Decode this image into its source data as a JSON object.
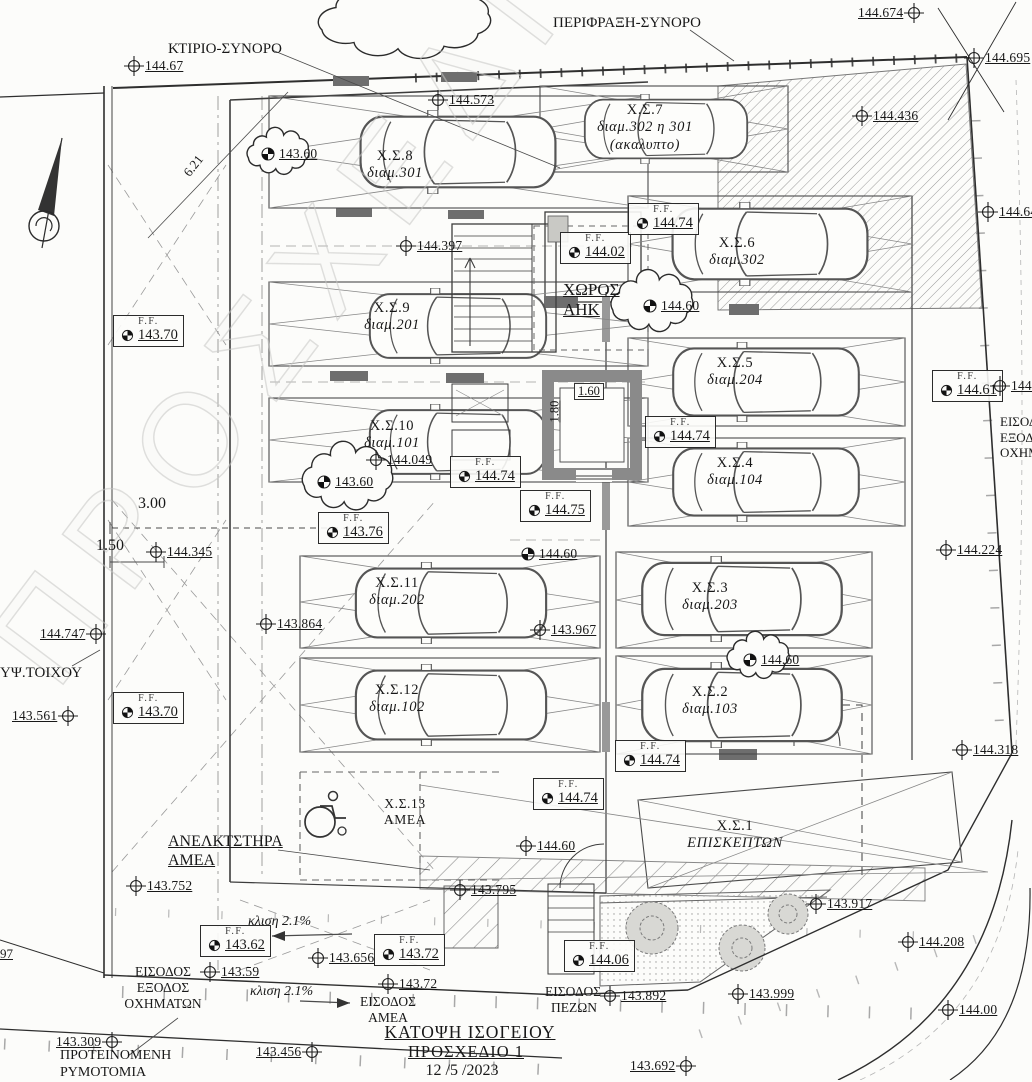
{
  "drawing": {
    "title_line1": "ΚΑΤΟΨΗ ΙΣΟΓΕΙΟΥ",
    "title_line2": "ΠΡΟΣΧΕΔΙΟ 1",
    "date": "12 /5 /2023",
    "watermark": "ΠΡΟΣΧΕΔΙΟ"
  },
  "boundary": {
    "building_label": "ΚΤΙΡΙΟ-ΣΥΝΟΡΟ",
    "fence_label": "ΠΕΡΙΦΡΑΞΗ-ΣΥΝΟΡΟ",
    "wall_height_label": "ΥΨ.ΤΟΙΧΟΥ",
    "proposed_line1": "ΠΡΟΤΕΙΝΟΜΕΝΗ",
    "proposed_line2": "ΡΥΜΟΤΟΜΙΑ"
  },
  "rooms": {
    "ahk_line1": "ΧΩΡΟΣ",
    "ahk_line2": "ΑΗΚ",
    "lift_line1": "ΑΝΕΛΚΤΣΤΗΡΑ",
    "lift_line2": "ΑΜΕΑ"
  },
  "entrances": {
    "vehicles_line1": "ΕΙΣΟΔΟΣ",
    "vehicles_line2": "ΕΞΟΔΟΣ",
    "vehicles_line3": "ΟΧΗΜΑΤΩΝ",
    "amea_line1": "ΕΙΣΟΔΟΣ",
    "amea_line2": "ΑΜΕΑ",
    "pedestrian_line1": "ΕΙΣΟΔΟΣ",
    "pedestrian_line2": "ΠΕΖΩΝ",
    "slope1": "κλιση 2.1%",
    "slope2": "κλιση 2.1%",
    "right": [
      "ΕΙΣΟΔ",
      "ΕΞΟΔ",
      "ΟΧΗΜ"
    ]
  },
  "parking": [
    {
      "name": "Χ.Σ.1",
      "sub": "ΕΠΙΣΚΕΠΤΩΝ"
    },
    {
      "name": "Χ.Σ.2",
      "sub": "διαμ.103"
    },
    {
      "name": "Χ.Σ.3",
      "sub": "διαμ.203"
    },
    {
      "name": "Χ.Σ.4",
      "sub": "διαμ.104"
    },
    {
      "name": "Χ.Σ.5",
      "sub": "διαμ.204"
    },
    {
      "name": "Χ.Σ.6",
      "sub": "διαμ.302"
    },
    {
      "name": "Χ.Σ.7",
      "sub": "διαμ.302  η  301",
      "sub2": "(ακαλυπτο)"
    },
    {
      "name": "Χ.Σ.8",
      "sub": "διαμ.301"
    },
    {
      "name": "Χ.Σ.9",
      "sub": "διαμ.201"
    },
    {
      "name": "Χ.Σ.10",
      "sub": "διαμ.101"
    },
    {
      "name": "Χ.Σ.11",
      "sub": "διαμ.202"
    },
    {
      "name": "Χ.Σ.12",
      "sub": "διαμ.102"
    },
    {
      "name": "Χ.Σ.13",
      "sub": "ΑΜΕΑ"
    }
  ],
  "ff_label": "F.F.",
  "ff": [
    {
      "v": "143.70"
    },
    {
      "v": "144.02"
    },
    {
      "v": "144.74"
    },
    {
      "v": "144.74"
    },
    {
      "v": "144.75"
    },
    {
      "v": "144.74"
    },
    {
      "v": "143.76"
    },
    {
      "v": "143.70"
    },
    {
      "v": "144.74"
    },
    {
      "v": "144.74"
    },
    {
      "v": "144.61"
    },
    {
      "v": "143.62"
    },
    {
      "v": "143.72"
    },
    {
      "v": "144.06"
    }
  ],
  "spots": [
    {
      "v": "144.674"
    },
    {
      "v": "144.695"
    },
    {
      "v": "144.67"
    },
    {
      "v": "144.573"
    },
    {
      "v": "144.436"
    },
    {
      "v": "144.64"
    },
    {
      "v": "144.397"
    },
    {
      "v": "144.60"
    },
    {
      "v": "144.049"
    },
    {
      "v": "143.60"
    },
    {
      "v": "143.60"
    },
    {
      "v": "144.345"
    },
    {
      "v": "144.224"
    },
    {
      "v": "143.864"
    },
    {
      "v": "143.967"
    },
    {
      "v": "144.60"
    },
    {
      "v": "144.60"
    },
    {
      "v": "144.747"
    },
    {
      "v": "143.561"
    },
    {
      "v": "144.318"
    },
    {
      "v": "143.752"
    },
    {
      "v": "143.795"
    },
    {
      "v": "143.917"
    },
    {
      "v": "144.208"
    },
    {
      "v": "144.00"
    },
    {
      "v": "143.999"
    },
    {
      "v": "143.892"
    },
    {
      "v": "143.59"
    },
    {
      "v": "143.656"
    },
    {
      "v": "143.72"
    },
    {
      "v": "143.309"
    },
    {
      "v": "143.456"
    },
    {
      "v": "143.692"
    },
    {
      "v": "144.60"
    },
    {
      "v": "144."
    },
    {
      "v": "97"
    }
  ],
  "dims": {
    "diag": "6.21",
    "w300": "3.00",
    "w150": "1.50",
    "lift_w": "1.60",
    "lift_d": "1.80"
  }
}
